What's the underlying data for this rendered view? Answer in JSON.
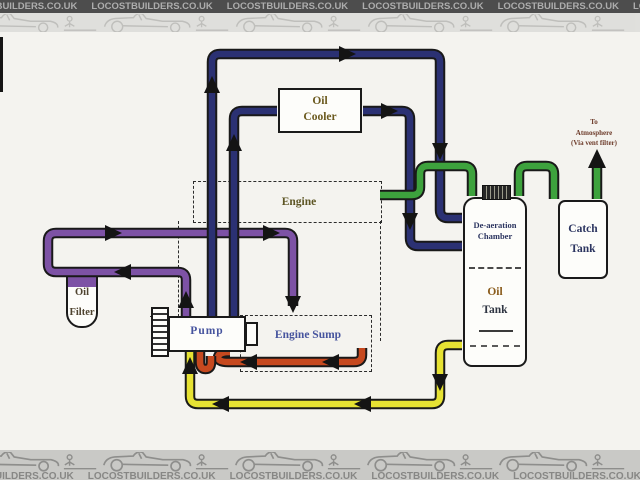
{
  "banner": {
    "site_text": "LOCOSTBUILDERS.CO.UK"
  },
  "note": {
    "l1": "To",
    "l2": "Atmosphere",
    "l3": "(Via vent filter)"
  },
  "labels": {
    "oil_cooler_1": "Oil",
    "oil_cooler_2": "Cooler",
    "engine": "Engine",
    "engine_sump": "Engine Sump",
    "pump": "Pump",
    "oil_filter_1": "Oil",
    "oil_filter_2": "Filter",
    "deaeration_1": "De-aeration",
    "deaeration_2": "Chamber",
    "oil_tank_1": "Oil",
    "oil_tank_2": "Tank",
    "catch_tank_1": "Catch",
    "catch_tank_2": "Tank"
  },
  "pipes": {
    "scavenge_blue": "#2b3173",
    "cooler_blue": "#2b3173",
    "pressure_purple": "#7d52a5",
    "breather_green": "#3da23d",
    "feed_yellow": "#e6e233",
    "pickup_red": "#c6491f",
    "drop_arrow_magenta": "#96337d"
  }
}
